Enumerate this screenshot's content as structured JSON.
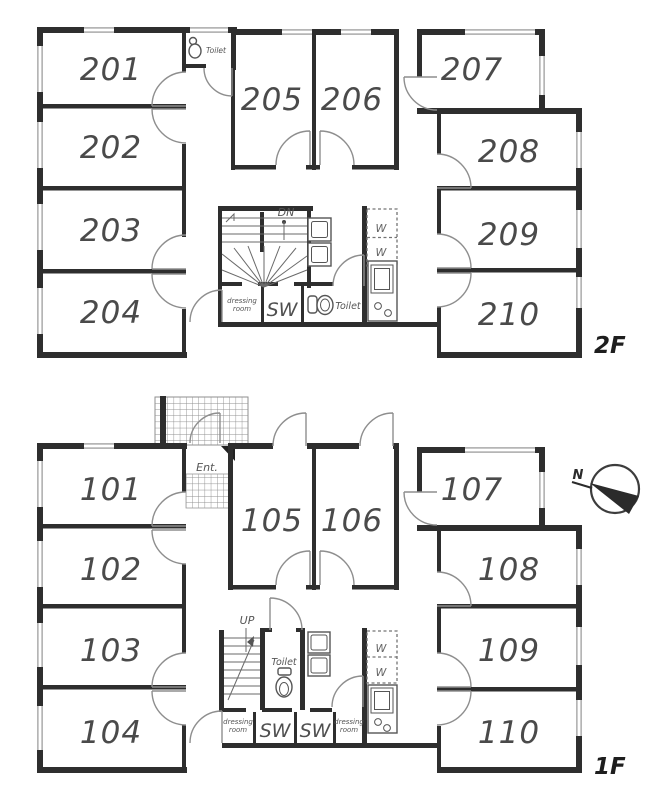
{
  "colors": {
    "wall": "#2e2e2e",
    "door_arc": "#8e8e8e",
    "window": "#b5b5b5",
    "room_text": "#4a4a4a",
    "label_text": "#555555",
    "background": "#ffffff"
  },
  "compass": {
    "north_label": "N"
  },
  "floor2": {
    "label": "2F",
    "rooms": {
      "r201": "201",
      "r202": "202",
      "r203": "203",
      "r204": "204",
      "r205": "205",
      "r206": "206",
      "r207": "207",
      "r208": "208",
      "r209": "209",
      "r210": "210"
    },
    "stairs_label": "DN",
    "toilet_upper_label": "Toilet",
    "toilet_label": "Toilet",
    "shower_label": "SW",
    "dressing_room": {
      "line1": "dressing",
      "line2": "room"
    },
    "washer_labels": [
      "W",
      "W"
    ]
  },
  "floor1": {
    "label": "1F",
    "rooms": {
      "r101": "101",
      "r102": "102",
      "r103": "103",
      "r104": "104",
      "r105": "105",
      "r106": "106",
      "r107": "107",
      "r108": "108",
      "r109": "109",
      "r110": "110"
    },
    "stairs_label": "UP",
    "entrance_label": "Ent.",
    "toilet_label": "Toilet",
    "shower_left_label": "SW",
    "shower_right_label": "SW",
    "dressing_room_left": {
      "line1": "dressing",
      "line2": "room"
    },
    "dressing_room_right": {
      "line1": "dressing",
      "line2": "room"
    },
    "washer_labels": [
      "W",
      "W"
    ]
  }
}
